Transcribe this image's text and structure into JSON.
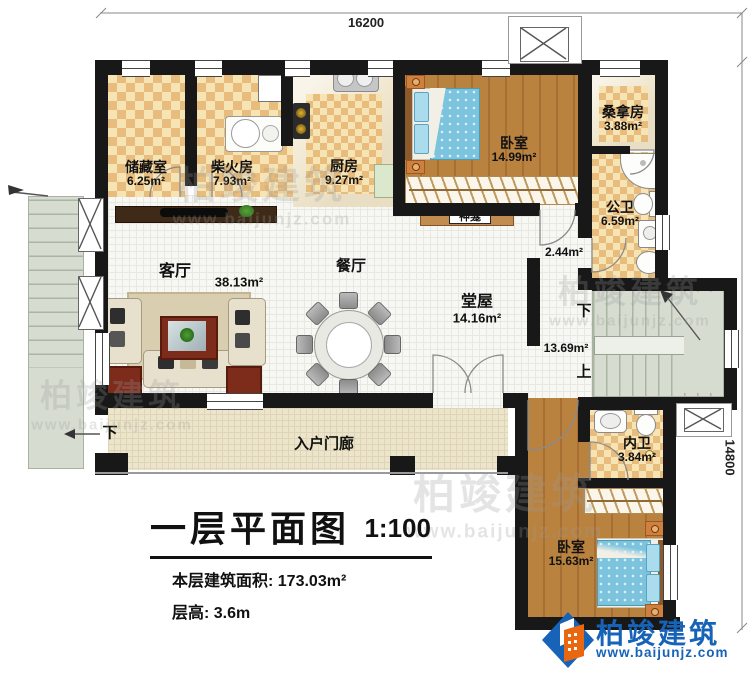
{
  "dimensions": {
    "top": "16200",
    "right": "14800"
  },
  "rooms": {
    "storage": {
      "name": "储藏室",
      "area": "6.25m²"
    },
    "firewood": {
      "name": "柴火房",
      "area": "7.93m²"
    },
    "kitchen": {
      "name": "厨房",
      "area": "9.27m²"
    },
    "bedroom_top": {
      "name": "卧室",
      "area": "14.99m²"
    },
    "sauna": {
      "name": "桑拿房",
      "area": "3.88m²"
    },
    "public_bath": {
      "name": "公卫",
      "area": "6.59m²"
    },
    "shrine": {
      "name": "神龛"
    },
    "living": {
      "name": "客厅",
      "area": "38.13m²"
    },
    "dining": {
      "name": "餐厅"
    },
    "hall": {
      "name": "堂屋",
      "area": "14.16m²"
    },
    "nook": {
      "area": "2.44m²"
    },
    "stair_lobby": {
      "area": "13.69m²"
    },
    "inner_bath": {
      "name": "内卫",
      "area": "3.84m²"
    },
    "bedroom_bottom": {
      "name": "卧室",
      "area": "15.63m²"
    },
    "porch": {
      "name": "入户门廊"
    }
  },
  "stair_labels": {
    "down": "下",
    "up": "上",
    "porch_down": "下"
  },
  "title": {
    "name": "一层平面图",
    "scale": "1:100",
    "area_line": "本层建筑面积: 173.03m²",
    "height_line": "层高: 3.6m"
  },
  "brand": {
    "name": "柏竣建筑",
    "url": "www.baijunjz.com"
  },
  "watermark": {
    "name": "柏竣建筑",
    "url": "www.baijunjz.com"
  },
  "colors": {
    "wall": "#181818",
    "wood": "#b9823f",
    "checker_dark": "#e7bc7d",
    "checker_light": "#f7e4b4",
    "bed_blue": "#7cc4de",
    "stair_green": "#d6dcd0",
    "brand_blue": "#1763b8",
    "brand_orange": "#e8670f"
  }
}
